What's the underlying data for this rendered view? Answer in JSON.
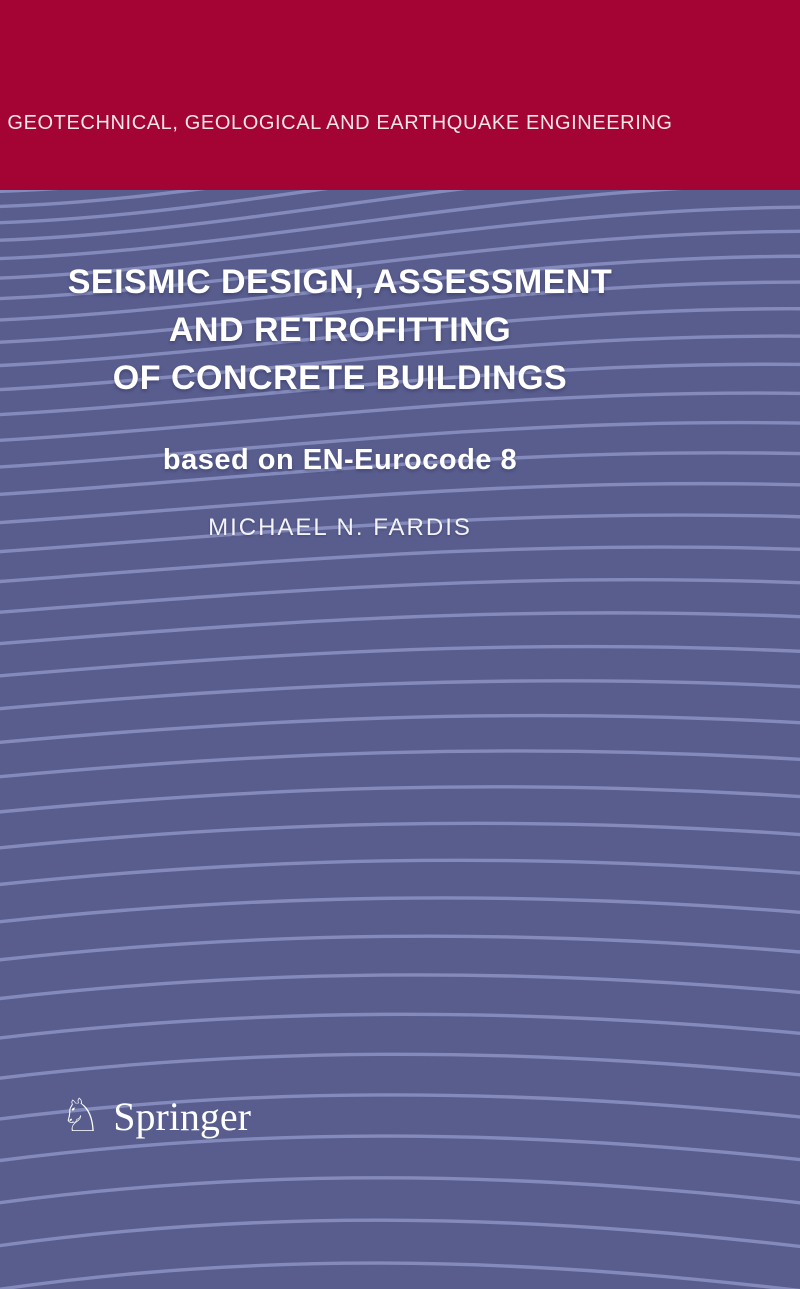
{
  "cover": {
    "series_title": "GEOTECHNICAL, GEOLOGICAL AND EARTHQUAKE ENGINEERING",
    "title_lines": [
      "SEISMIC DESIGN, ASSESSMENT",
      "AND RETROFITTING",
      "OF CONCRETE BUILDINGS"
    ],
    "subtitle": "based on EN-Eurocode 8",
    "author": "MICHAEL N. FARDIS",
    "publisher": {
      "name": "Springer",
      "logo_icon": "springer-horse-icon",
      "logo_glyph": "♘"
    },
    "colors": {
      "banner": "#A30434",
      "background": "#585D8E",
      "wave_line": "#8A90C1",
      "text": "#FFFFFF"
    }
  }
}
